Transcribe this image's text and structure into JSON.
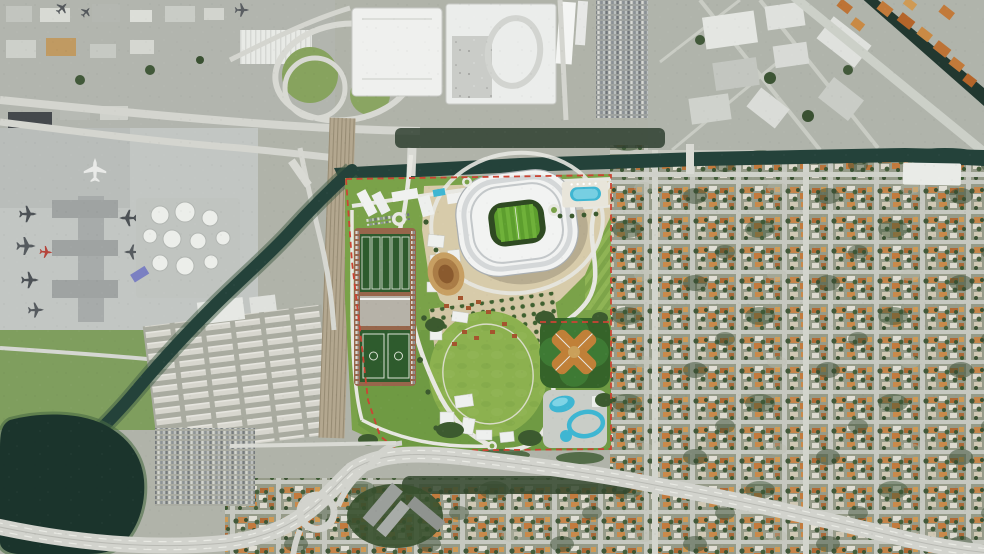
{
  "meta": {
    "title": "aerial-satellite-view-stadium-site-plan",
    "description": "Satellite aerial view with rendered soccer-stadium park development outlined by red dashed boundary, airport to the west, expressways, canal and dense residential grid to the east"
  },
  "palette": {
    "base_urban": "#b0b3a9",
    "residential_base": "#969b89",
    "street_gray": "#c6c8c0",
    "road_major": "#d2d3cd",
    "road_white": "#e8e8e2",
    "water_canal": "#24423a",
    "water_lake": "#1b342c",
    "water_river": "#223830",
    "site_green": "#7aa249",
    "park_green": "#6f9a43",
    "lawn_green": "#8cb14f",
    "plaza_tan": "#d7cbaa",
    "parking_rust": "#97664b",
    "field_green": "#2e5b2d",
    "stadium_roof": "#f2f3f2",
    "stadium_rim": "#a9aeb1",
    "pitch_green": "#5d9e2e",
    "pool_blue": "#3fb6d2",
    "boundary_red": "#cb4434",
    "infield_orange": "#c08038",
    "tree_green": "#3c5a2f",
    "concrete": "#c2c6c3",
    "industrial_gray": "#b2b5ae",
    "warehouse_white": "#e8eae6",
    "rail_tan": "#b3a78f",
    "house_orange": "#c5854a",
    "tank_white": "#eceeea"
  },
  "scene": {
    "regions": [
      {
        "id": "airport-terminal",
        "label": "airport terminal with parked airplanes"
      },
      {
        "id": "fuel-tank-farm",
        "label": "circular fuel storage tanks"
      },
      {
        "id": "rail-yard",
        "label": "diagonal railroad corridor"
      },
      {
        "id": "canal",
        "label": "dark canal along north edge of site"
      },
      {
        "id": "diagonal-canal",
        "label": "canal running southwest to lake"
      },
      {
        "id": "lake",
        "label": "dark lake at bottom left"
      },
      {
        "id": "interchange",
        "label": "elevated expressway interchange"
      },
      {
        "id": "expressway",
        "label": "east-west expressway across bottom"
      },
      {
        "id": "intermodal-center",
        "label": "large white-roofed transit buildings top center"
      },
      {
        "id": "parking-garages",
        "label": "parking structures full of cars"
      },
      {
        "id": "industrial-district",
        "label": "warehouse district top right"
      },
      {
        "id": "river",
        "label": "river in top right corner"
      },
      {
        "id": "residential-grid",
        "label": "dense orange-roofed residential grid east"
      },
      {
        "id": "site-boundary",
        "label": "red dashed development boundary"
      },
      {
        "id": "stadium",
        "label": "white stadium with green pitch"
      },
      {
        "id": "training-fields",
        "label": "training field complex"
      },
      {
        "id": "great-lawn",
        "label": "oval great lawn"
      },
      {
        "id": "baseball-cloverleaf",
        "label": "four baseball diamonds in cloverleaf"
      },
      {
        "id": "water-park",
        "label": "water park with blue pools"
      },
      {
        "id": "amphitheater",
        "label": "oval amphitheater"
      },
      {
        "id": "lagoon-pool",
        "label": "rectangular lagoon pool deck"
      },
      {
        "id": "trailer-park",
        "label": "dense rows of mobile homes"
      },
      {
        "id": "hotel-complex",
        "label": "dark building complex below expressway"
      }
    ]
  }
}
